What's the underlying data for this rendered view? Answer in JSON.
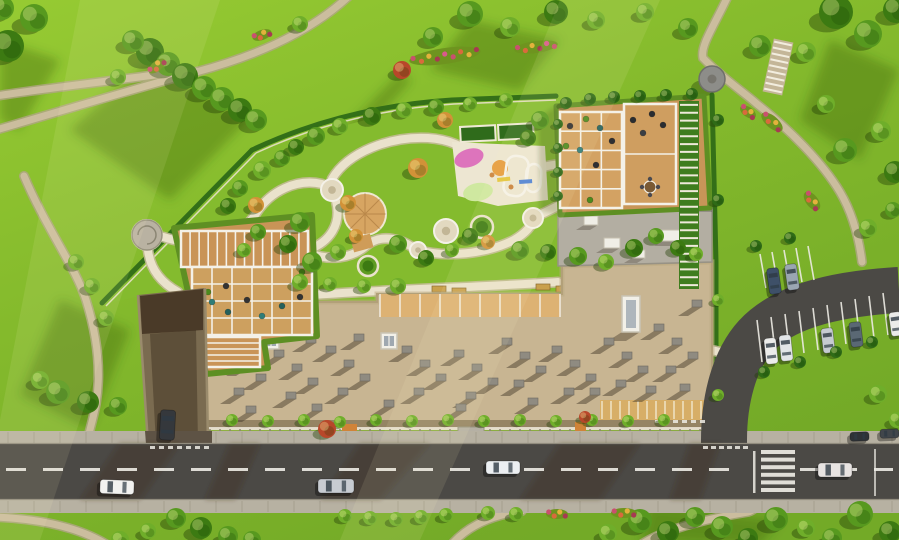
{
  "scene": {
    "type": "aerial-masterplan-render",
    "subject": "residential complex with landscaped rooftop courtyard, park, road and parking",
    "palette": {
      "lawn": "#7FB42A",
      "lawnHi": "#A7D63C",
      "lawnLo": "#6AA023",
      "shade": "#3E7212",
      "path": "#CBBD9E",
      "pathEdge": "#B2A588",
      "courtPath": "#EAE2CC",
      "courtPathEdge": "#C9BC9E",
      "road": "#4B4945",
      "sidewalk": "#B7B1A2",
      "curb": "#918C7E",
      "marking": "#EDEBE4",
      "roof": "#C8B592",
      "roofEdge": "#A6946F",
      "grayRoof": "#B3AEA2",
      "wood": "#C99457",
      "woodLight": "#DDB273",
      "pergola": "#F4F1E8",
      "hedge": "#2F6B17",
      "ramp": "#7A6B50",
      "rampDark": "#4A3A28",
      "rampWall": "#9A8B6C",
      "orangeCanopy": "#D7AE67",
      "treeColors": {
        "t": "#57991F",
        "d": "#3C7A12",
        "b": "#6FAE2A",
        "a": "#D29238",
        "r": "#B8472A",
        "h": "#2F6B17",
        "l": "#8CC63E"
      }
    }
  },
  "trees": [
    [
      150,
      52,
      14,
      "d"
    ],
    [
      168,
      64,
      12,
      "t"
    ],
    [
      185,
      76,
      13,
      "d"
    ],
    [
      204,
      88,
      12,
      "t"
    ],
    [
      222,
      99,
      12,
      "t"
    ],
    [
      240,
      110,
      12,
      "d"
    ],
    [
      133,
      41,
      11,
      "t"
    ],
    [
      256,
      120,
      11,
      "t"
    ],
    [
      118,
      77,
      8,
      "b"
    ],
    [
      8,
      46,
      16,
      "d"
    ],
    [
      34,
      18,
      14,
      "t"
    ],
    [
      2,
      8,
      12,
      "t"
    ],
    [
      433,
      37,
      10,
      "t"
    ],
    [
      470,
      14,
      13,
      "t"
    ],
    [
      510,
      27,
      10,
      "b"
    ],
    [
      556,
      12,
      12,
      "d"
    ],
    [
      402,
      70,
      9,
      "r"
    ],
    [
      300,
      24,
      8,
      "b"
    ],
    [
      596,
      20,
      9,
      "b"
    ],
    [
      836,
      12,
      17,
      "d"
    ],
    [
      868,
      34,
      14,
      "t"
    ],
    [
      896,
      10,
      13,
      "d"
    ],
    [
      806,
      52,
      10,
      "b"
    ],
    [
      760,
      46,
      11,
      "t"
    ],
    [
      688,
      28,
      10,
      "t"
    ],
    [
      645,
      12,
      9,
      "b"
    ],
    [
      845,
      150,
      12,
      "t"
    ],
    [
      881,
      131,
      10,
      "b"
    ],
    [
      895,
      172,
      11,
      "d"
    ],
    [
      826,
      104,
      9,
      "b"
    ],
    [
      868,
      228,
      9,
      "b"
    ],
    [
      893,
      210,
      8,
      "t"
    ],
    [
      878,
      394,
      9,
      "b"
    ],
    [
      897,
      420,
      8,
      "b"
    ],
    [
      640,
      521,
      12,
      "t"
    ],
    [
      668,
      532,
      11,
      "d"
    ],
    [
      695,
      517,
      10,
      "t"
    ],
    [
      722,
      527,
      11,
      "t"
    ],
    [
      748,
      538,
      10,
      "d"
    ],
    [
      608,
      533,
      9,
      "b"
    ],
    [
      776,
      519,
      12,
      "t"
    ],
    [
      860,
      514,
      13,
      "t"
    ],
    [
      890,
      532,
      11,
      "d"
    ],
    [
      832,
      538,
      10,
      "t"
    ],
    [
      806,
      528,
      9,
      "b"
    ],
    [
      345,
      516,
      7,
      "b"
    ],
    [
      370,
      518,
      7,
      "b"
    ],
    [
      396,
      519,
      7,
      "b"
    ],
    [
      421,
      517,
      7,
      "b"
    ],
    [
      446,
      515,
      7,
      "b"
    ],
    [
      488,
      513,
      7,
      "b"
    ],
    [
      516,
      514,
      7,
      "b"
    ],
    [
      176,
      518,
      10,
      "t"
    ],
    [
      201,
      528,
      11,
      "d"
    ],
    [
      228,
      536,
      10,
      "t"
    ],
    [
      252,
      540,
      9,
      "t"
    ],
    [
      148,
      531,
      8,
      "b"
    ],
    [
      120,
      540,
      9,
      "b"
    ],
    [
      58,
      392,
      12,
      "t"
    ],
    [
      88,
      402,
      11,
      "d"
    ],
    [
      118,
      406,
      9,
      "t"
    ],
    [
      40,
      380,
      9,
      "b"
    ],
    [
      92,
      286,
      8,
      "b"
    ],
    [
      76,
      262,
      8,
      "b"
    ],
    [
      106,
      318,
      8,
      "b"
    ],
    [
      262,
      170,
      9,
      "b"
    ],
    [
      282,
      158,
      8,
      "t"
    ],
    [
      296,
      147,
      8,
      "d"
    ],
    [
      316,
      136,
      9,
      "t"
    ],
    [
      340,
      126,
      8,
      "b"
    ],
    [
      372,
      116,
      9,
      "d"
    ],
    [
      404,
      110,
      8,
      "b"
    ],
    [
      436,
      107,
      8,
      "t"
    ],
    [
      470,
      104,
      7,
      "b"
    ],
    [
      506,
      100,
      7,
      "b"
    ],
    [
      540,
      120,
      9,
      "t"
    ],
    [
      528,
      138,
      8,
      "d"
    ],
    [
      300,
      222,
      10,
      "t"
    ],
    [
      288,
      244,
      9,
      "d"
    ],
    [
      312,
      262,
      10,
      "t"
    ],
    [
      338,
      252,
      8,
      "b"
    ],
    [
      356,
      236,
      7,
      "a"
    ],
    [
      398,
      244,
      9,
      "t"
    ],
    [
      426,
      258,
      8,
      "d"
    ],
    [
      452,
      250,
      7,
      "b"
    ],
    [
      300,
      282,
      8,
      "b"
    ],
    [
      330,
      284,
      7,
      "b"
    ],
    [
      364,
      286,
      7,
      "b"
    ],
    [
      398,
      286,
      8,
      "b"
    ],
    [
      470,
      236,
      8,
      "d"
    ],
    [
      520,
      250,
      9,
      "t"
    ],
    [
      548,
      252,
      8,
      "d"
    ],
    [
      578,
      256,
      9,
      "t"
    ],
    [
      606,
      262,
      8,
      "b"
    ],
    [
      634,
      248,
      9,
      "d"
    ],
    [
      656,
      236,
      8,
      "t"
    ],
    [
      678,
      248,
      8,
      "d"
    ],
    [
      696,
      254,
      7,
      "b"
    ],
    [
      418,
      168,
      10,
      "a"
    ],
    [
      348,
      203,
      8,
      "a"
    ],
    [
      488,
      242,
      7,
      "a"
    ],
    [
      445,
      120,
      8,
      "a"
    ],
    [
      256,
      205,
      8,
      "a"
    ],
    [
      240,
      188,
      8,
      "t"
    ],
    [
      228,
      206,
      8,
      "d"
    ],
    [
      258,
      232,
      8,
      "t"
    ],
    [
      244,
      250,
      7,
      "b"
    ],
    [
      566,
      103,
      6,
      "h"
    ],
    [
      590,
      99,
      6,
      "h"
    ],
    [
      614,
      97,
      6,
      "h"
    ],
    [
      640,
      96,
      6,
      "h"
    ],
    [
      666,
      95,
      6,
      "h"
    ],
    [
      692,
      94,
      6,
      "h"
    ],
    [
      558,
      124,
      5,
      "h"
    ],
    [
      558,
      148,
      5,
      "h"
    ],
    [
      558,
      172,
      5,
      "h"
    ],
    [
      558,
      196,
      5,
      "h"
    ],
    [
      718,
      120,
      6,
      "h"
    ],
    [
      718,
      200,
      6,
      "h"
    ],
    [
      718,
      300,
      6,
      "b"
    ],
    [
      718,
      395,
      6,
      "b"
    ],
    [
      232,
      420,
      6,
      "b"
    ],
    [
      268,
      421,
      6,
      "b"
    ],
    [
      304,
      420,
      6,
      "b"
    ],
    [
      340,
      422,
      6,
      "b"
    ],
    [
      376,
      420,
      6,
      "b"
    ],
    [
      412,
      421,
      6,
      "b"
    ],
    [
      448,
      420,
      6,
      "b"
    ],
    [
      484,
      421,
      6,
      "b"
    ],
    [
      520,
      420,
      6,
      "b"
    ],
    [
      556,
      421,
      6,
      "b"
    ],
    [
      592,
      420,
      6,
      "b"
    ],
    [
      628,
      421,
      6,
      "b"
    ],
    [
      664,
      420,
      6,
      "b"
    ],
    [
      327,
      429,
      9,
      "r"
    ],
    [
      585,
      417,
      6,
      "r"
    ],
    [
      756,
      246,
      6,
      "h"
    ],
    [
      790,
      238,
      6,
      "h"
    ],
    [
      764,
      372,
      6,
      "h"
    ],
    [
      800,
      362,
      6,
      "h"
    ],
    [
      836,
      352,
      6,
      "h"
    ],
    [
      872,
      342,
      6,
      "h"
    ]
  ],
  "flowerBeds": [
    [
      445,
      56,
      36,
      8,
      -8
    ],
    [
      536,
      47,
      22,
      6,
      -8
    ],
    [
      157,
      66,
      10,
      5,
      -40
    ],
    [
      772,
      122,
      13,
      6,
      40
    ],
    [
      812,
      201,
      11,
      6,
      52
    ],
    [
      748,
      112,
      9,
      5,
      35
    ],
    [
      624,
      513,
      13,
      5,
      0
    ],
    [
      557,
      514,
      11,
      5,
      0
    ],
    [
      262,
      35,
      10,
      5,
      -20
    ]
  ],
  "flowerColors": [
    "#C9506E",
    "#D96A3C",
    "#E3B23C",
    "#A73A52",
    "#D95A8C"
  ],
  "nodes": [
    [
      332,
      190,
      11,
      "p"
    ],
    [
      446,
      231,
      12,
      "p"
    ],
    [
      482,
      227,
      11,
      "g"
    ],
    [
      533,
      218,
      10,
      "p"
    ],
    [
      418,
      250,
      8,
      "p"
    ],
    [
      368,
      266,
      10,
      "g"
    ],
    [
      303,
      253,
      8,
      "p"
    ],
    [
      147,
      235,
      15,
      "z"
    ]
  ],
  "playground": {
    "pads": [
      [
        469,
        158,
        15,
        9,
        -18,
        "#DD74BC"
      ],
      [
        478,
        192,
        15,
        9,
        -10,
        "#CFE8A0"
      ]
    ],
    "circles": [
      [
        500,
        168,
        8,
        "#E69A3C"
      ]
    ],
    "loops": [
      [
        505,
        156,
        22,
        40,
        8
      ],
      [
        526,
        164,
        15,
        28,
        4
      ]
    ],
    "bars": [
      [
        497,
        178,
        13,
        4,
        -6,
        "#E4C43C"
      ],
      [
        519,
        180,
        13,
        4,
        -4,
        "#4F82D6"
      ]
    ],
    "dots": [
      [
        492,
        175
      ],
      [
        511,
        187
      ]
    ],
    "planters": [
      [
        460,
        127,
        35,
        15,
        -3
      ],
      [
        498,
        125,
        35,
        15,
        -3
      ]
    ]
  },
  "benches": [
    [
      432,
      286,
      14,
      6
    ],
    [
      452,
      288,
      14,
      6
    ],
    [
      536,
      284,
      14,
      6
    ],
    [
      556,
      286,
      14,
      6
    ],
    [
      610,
      226,
      6,
      14
    ]
  ],
  "furniture": [
    [
      212,
      302,
      "#2F7D78"
    ],
    [
      228,
      312,
      "#23605C"
    ],
    [
      247,
      300,
      "#333333"
    ],
    [
      262,
      316,
      "#2F7D78"
    ],
    [
      226,
      286,
      "#333333"
    ],
    [
      282,
      306,
      "#23605C"
    ],
    [
      300,
      297,
      "#333333"
    ],
    [
      208,
      292,
      "#4C8A1D"
    ],
    [
      302,
      272,
      "#4C8A1D"
    ],
    [
      600,
      128,
      "#23605C"
    ],
    [
      612,
      141,
      "#2F2F33"
    ],
    [
      580,
      150,
      "#2F7D78"
    ],
    [
      596,
      165,
      "#2F2F33"
    ],
    [
      570,
      126,
      "#2F2F33"
    ],
    [
      586,
      119,
      "#4C8A1D"
    ],
    [
      566,
      146,
      "#4C8A1D"
    ],
    [
      590,
      200,
      "#4C8A1D"
    ],
    [
      633,
      120,
      "#2A2D31"
    ],
    [
      652,
      114,
      "#2A2D31"
    ],
    [
      643,
      133,
      "#3A3E44"
    ],
    [
      663,
      125,
      "#2A2D31"
    ]
  ],
  "dining": {
    "cx": 650,
    "cy": 187,
    "r": 6
  },
  "grids": [
    {
      "x": 181,
      "y": 231,
      "w": 127,
      "h": 36,
      "cols": 14,
      "rows": 1,
      "fill": "#C99457"
    },
    {
      "x": 192,
      "y": 267,
      "w": 120,
      "h": 68,
      "cols": 6,
      "rows": 4,
      "fill": "#CDA05F"
    },
    {
      "x": 200,
      "y": 337,
      "w": 60,
      "h": 30,
      "cols": 1,
      "rows": 5,
      "fill": "#C99457"
    },
    {
      "x": 560,
      "y": 112,
      "w": 62,
      "h": 96,
      "cols": 3,
      "rows": 5,
      "fill": "#D3A263"
    },
    {
      "x": 624,
      "y": 104,
      "w": 52,
      "h": 100,
      "cols": 1,
      "rows": 2,
      "fill": "#CF9E60"
    }
  ],
  "stripes": [
    {
      "x": 679,
      "y": 101,
      "w": 20,
      "h": 188,
      "n": 24,
      "c": "#EFE9DA",
      "base": "#3F7D1E",
      "rot": 0
    },
    {
      "x": 768,
      "y": 40,
      "w": 20,
      "h": 54,
      "n": 9,
      "c": "#F2EDDE",
      "base": "#C4B698",
      "rot": 12
    }
  ],
  "vents": [
    [
      222,
      346
    ],
    [
      240,
      360
    ],
    [
      256,
      374
    ],
    [
      234,
      388
    ],
    [
      274,
      350
    ],
    [
      292,
      364
    ],
    [
      308,
      378
    ],
    [
      286,
      392
    ],
    [
      326,
      346
    ],
    [
      344,
      360
    ],
    [
      360,
      374
    ],
    [
      338,
      388
    ],
    [
      306,
      336
    ],
    [
      354,
      334
    ],
    [
      402,
      346
    ],
    [
      420,
      360
    ],
    [
      436,
      374
    ],
    [
      414,
      388
    ],
    [
      454,
      350
    ],
    [
      472,
      364
    ],
    [
      488,
      378
    ],
    [
      466,
      392
    ],
    [
      502,
      338
    ],
    [
      520,
      352
    ],
    [
      536,
      366
    ],
    [
      514,
      380
    ],
    [
      552,
      346
    ],
    [
      570,
      360
    ],
    [
      586,
      374
    ],
    [
      564,
      388
    ],
    [
      604,
      338
    ],
    [
      622,
      352
    ],
    [
      638,
      366
    ],
    [
      616,
      380
    ],
    [
      654,
      324
    ],
    [
      672,
      338
    ],
    [
      688,
      352
    ],
    [
      666,
      366
    ],
    [
      680,
      384
    ],
    [
      646,
      386
    ],
    [
      590,
      388
    ],
    [
      528,
      398
    ],
    [
      456,
      404
    ],
    [
      384,
      400
    ],
    [
      312,
      404
    ],
    [
      246,
      406
    ],
    [
      692,
      300
    ]
  ],
  "ventSize": {
    "w": 10,
    "h": 7,
    "shadowDx": -14,
    "shadowDy": 9
  },
  "skylights": [
    [
      263,
      333,
      16
    ],
    [
      381,
      333,
      16
    ]
  ],
  "whiteBoxes": [
    [
      584,
      216,
      14,
      9
    ],
    [
      604,
      238,
      16,
      10
    ],
    [
      632,
      250,
      13,
      8
    ],
    [
      662,
      230,
      18,
      11
    ],
    [
      688,
      214,
      11,
      7
    ]
  ],
  "terraceDividers": {
    "x0": 380,
    "x1": 560,
    "step": 20,
    "y": 294,
    "h": 23,
    "c": "#F4F1E8"
  },
  "facadeTicks": {
    "x0": 210,
    "x1": 710,
    "step": 10,
    "y": 429,
    "h": 4,
    "c": "#8B8070"
  },
  "orangeTicks": {
    "x0": 602,
    "x1": 710,
    "step": 9,
    "y": 401,
    "h": 18,
    "c": "#F1E7CE"
  },
  "sidewalkJoints": [
    {
      "y": 432,
      "h": 11,
      "step": 26
    },
    {
      "y": 501,
      "h": 11,
      "step": 26
    }
  ],
  "centerline": {
    "y": 468,
    "h": 3,
    "len": 20,
    "gap": 17,
    "segments": [
      [
        6,
        740
      ],
      [
        800,
        893
      ]
    ]
  },
  "crosswalk": {
    "x": 761,
    "y": 450,
    "w": 34,
    "h": 4,
    "n": 6,
    "gap": 7.6
  },
  "dashRows": [
    {
      "x": 150,
      "y": 446,
      "n": 7,
      "w": 5,
      "h": 3,
      "gap": 9
    },
    {
      "x": 703,
      "y": 446,
      "n": 6,
      "w": 5,
      "h": 3,
      "gap": 8
    },
    {
      "x": 655,
      "y": 420,
      "n": 6,
      "w": 5,
      "h": 3,
      "gap": 9
    }
  ],
  "stallLines": {
    "upper": [
      [
        766,
        288,
        760,
        254
      ],
      [
        778,
        286,
        772,
        252
      ],
      [
        790,
        284,
        784,
        250
      ],
      [
        802,
        282,
        796,
        248
      ],
      [
        814,
        280,
        808,
        246
      ]
    ],
    "lower": [
      [
        762,
        362,
        757,
        320
      ],
      [
        776,
        359,
        771,
        317
      ],
      [
        790,
        356,
        785,
        314
      ],
      [
        804,
        353,
        799,
        311
      ],
      [
        818,
        350,
        813,
        308
      ],
      [
        832,
        347,
        827,
        305
      ],
      [
        846,
        344,
        841,
        302
      ],
      [
        860,
        341,
        855,
        299
      ],
      [
        874,
        338,
        869,
        296
      ],
      [
        888,
        335,
        883,
        293
      ]
    ]
  },
  "cars": {
    "road": [
      {
        "x": 100,
        "y": 480,
        "w": 34,
        "h": 14,
        "angle": 2,
        "color": "#F2F2F0"
      },
      {
        "x": 318,
        "y": 479,
        "w": 36,
        "h": 14,
        "angle": 0,
        "color": "#C8CCD2"
      },
      {
        "x": 486,
        "y": 461,
        "w": 34,
        "h": 13,
        "angle": 0,
        "color": "#ECEFF2"
      },
      {
        "x": 818,
        "y": 463,
        "w": 34,
        "h": 14,
        "angle": 0,
        "color": "#E8E4E2"
      }
    ],
    "parked": [
      {
        "x": 768,
        "y": 268,
        "w": 12,
        "h": 26,
        "angle": -8,
        "color": "#3E5068"
      },
      {
        "x": 786,
        "y": 264,
        "w": 12,
        "h": 26,
        "angle": -8,
        "color": "#9AA6B2"
      },
      {
        "x": 765,
        "y": 338,
        "w": 12,
        "h": 26,
        "angle": -6,
        "color": "#ECECEA"
      },
      {
        "x": 780,
        "y": 335,
        "w": 12,
        "h": 26,
        "angle": -6,
        "color": "#E2E5E7"
      },
      {
        "x": 822,
        "y": 328,
        "w": 12,
        "h": 25,
        "angle": -7,
        "color": "#C6CBD1"
      },
      {
        "x": 850,
        "y": 322,
        "w": 12,
        "h": 25,
        "angle": -7,
        "color": "#5A6874"
      },
      {
        "x": 890,
        "y": 312,
        "w": 12,
        "h": 24,
        "angle": -8,
        "color": "#EBEBE9"
      }
    ],
    "ramp": [
      {
        "x": 160,
        "y": 410,
        "w": 15,
        "h": 30,
        "angle": 3,
        "color": "#35383C"
      }
    ],
    "sidewalk": [
      {
        "x": 850,
        "y": 432,
        "w": 19,
        "h": 9,
        "angle": -2,
        "color": "#2E3236"
      },
      {
        "x": 880,
        "y": 429,
        "w": 19,
        "h": 9,
        "angle": -2,
        "color": "#41464B"
      }
    ]
  },
  "gazebo": {
    "cx": 712,
    "cy": 79,
    "r": 13
  }
}
